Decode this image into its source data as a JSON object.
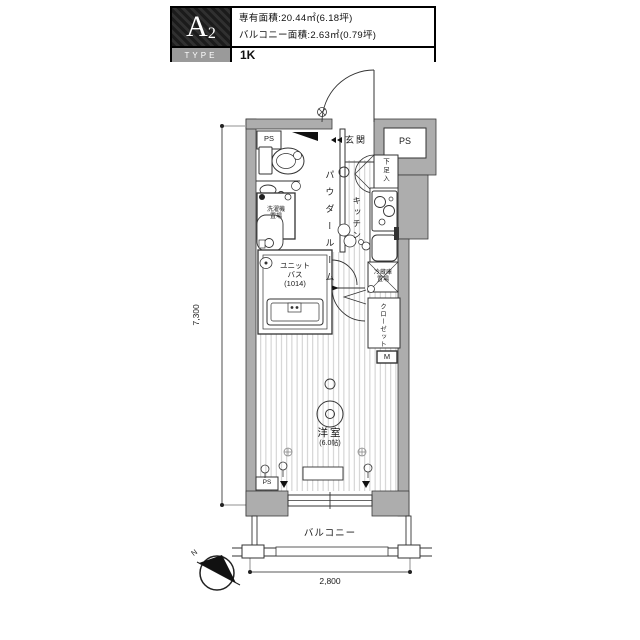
{
  "header": {
    "type_letter": "A",
    "type_number": "2",
    "type_label": "TYPE",
    "plan_type": "1K",
    "area_line1": "専有面積:20.44㎡(6.18坪)",
    "area_line2": "バルコニー面積:2.63㎡(0.79坪)"
  },
  "plan": {
    "labels": {
      "entrance": "玄関",
      "ps": "PS",
      "shoe_box": "下足入",
      "kitchen": "キッチン",
      "fridge": "冷蔵庫\n置場",
      "closet": "クローゼット",
      "meter": "M",
      "powder_room": "パウダールーム",
      "laundry": "洗濯機\n置場",
      "unit_bath": "ユニット\nバス\n(1014)",
      "main_room": "洋室",
      "main_room_size": "(6.0帖)",
      "balcony": "バルコニー"
    },
    "dimensions": {
      "vertical": "7,300",
      "horizontal": "2,800"
    },
    "compass": "N"
  },
  "colors": {
    "wall_fill": "#adadad",
    "line": "#3a3a3a",
    "floor_stripe": "#c9c9c9",
    "header_bg": "#000000",
    "type_box_bg": "#9a9a9a"
  }
}
